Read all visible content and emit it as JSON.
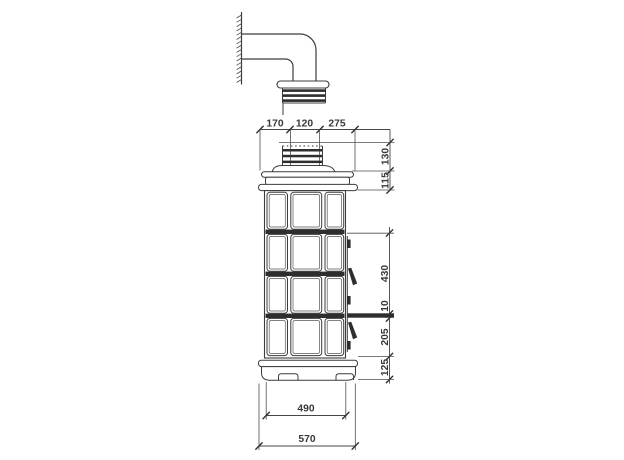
{
  "meta": {
    "type": "technical-dimension-drawing",
    "subject": "tiled stove side elevation with wall flue connector",
    "units": "mm"
  },
  "colors": {
    "background": "#ffffff",
    "line": "#3c3c3c",
    "dark_fill": "#2e2e2e",
    "dimension_text": "#383838"
  },
  "dimensions": {
    "top": {
      "left_offset": "170",
      "flue_diameter": "120",
      "right_offset": "275"
    },
    "upper_right": {
      "collar_height": "130",
      "crown_height": "115"
    },
    "lower_right": {
      "upper_section": "430",
      "tile_gap": "10",
      "lower_section": "205",
      "base_height": "125"
    },
    "bottom": {
      "body_width": "490",
      "overall_width": "570"
    }
  }
}
